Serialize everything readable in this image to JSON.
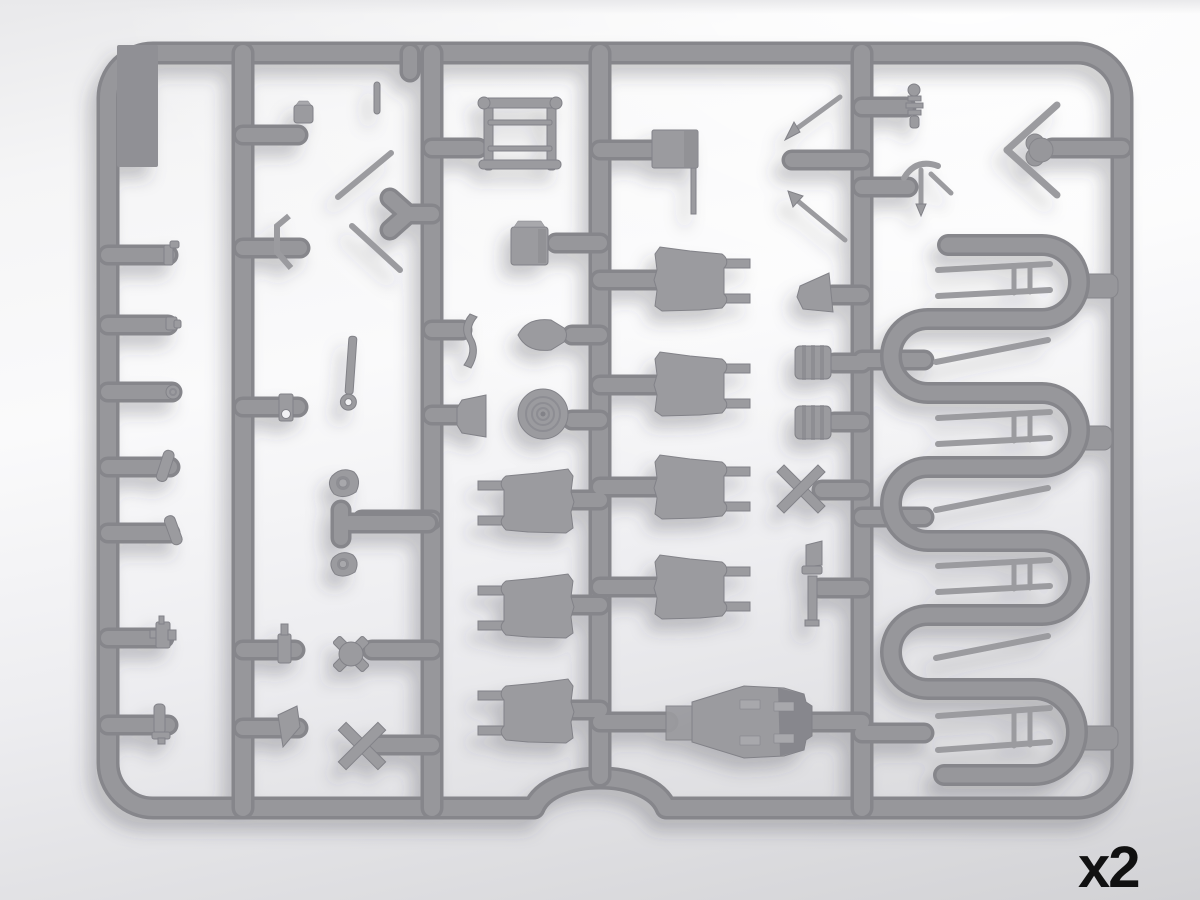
{
  "scene": {
    "alt": "Gray injection-molded plastic model kit sprue frame with assorted parts",
    "quantity_label": "x2"
  },
  "colors": {
    "sprue": "#97979b",
    "sprueDark": "#86868b",
    "sprueLight": "#a8a8ac",
    "part": "#9b9b9f",
    "partDark": "#828288",
    "panel": "#909095",
    "bgTop": "#e9e9eb",
    "bgMid": "#fafafb",
    "bgBottom": "#d2d2d5",
    "label": "#111111",
    "shadow": "#3c3c46"
  }
}
